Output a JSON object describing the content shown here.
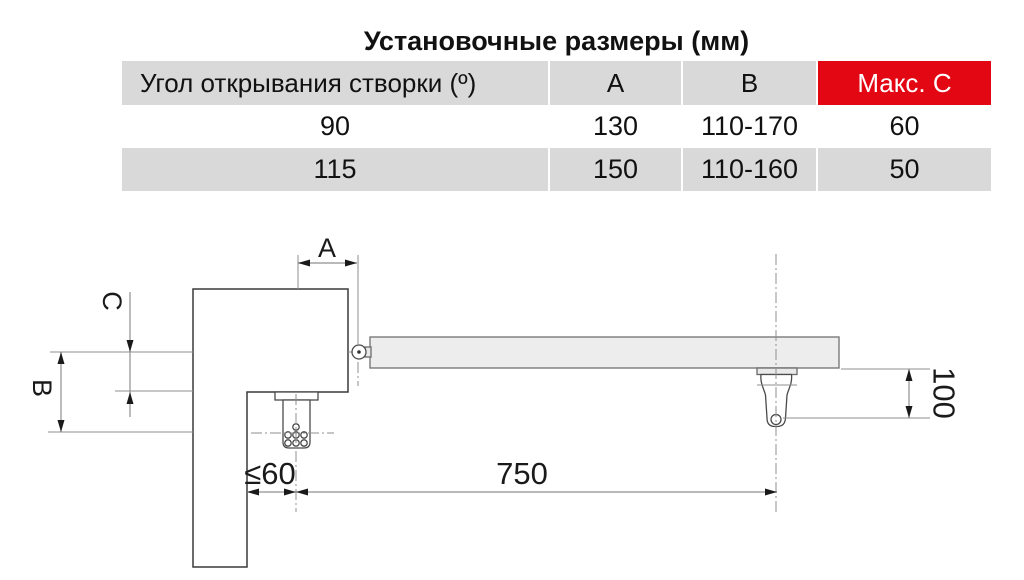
{
  "table": {
    "title": "Установочные размеры (мм)",
    "header": {
      "col0": "Угол открывания створки (º)",
      "col1": "A",
      "col2": "B",
      "col3": "Макс. C"
    },
    "rows": [
      {
        "angle": "90",
        "a": "130",
        "b": "110-170",
        "c": "60"
      },
      {
        "angle": "115",
        "a": "150",
        "b": "110-160",
        "c": "50"
      }
    ],
    "colors": {
      "header_bg": "#d9d9d9",
      "alt_row_bg": "#d9d9d9",
      "max_c_bg": "#e30613",
      "max_c_text": "#ffffff"
    }
  },
  "drawing": {
    "dimensions": {
      "a_label": "A",
      "b_label": "B",
      "c_label": "C",
      "post_offset": "≤60",
      "arm_length": "750",
      "bracket_drop": "100"
    }
  }
}
